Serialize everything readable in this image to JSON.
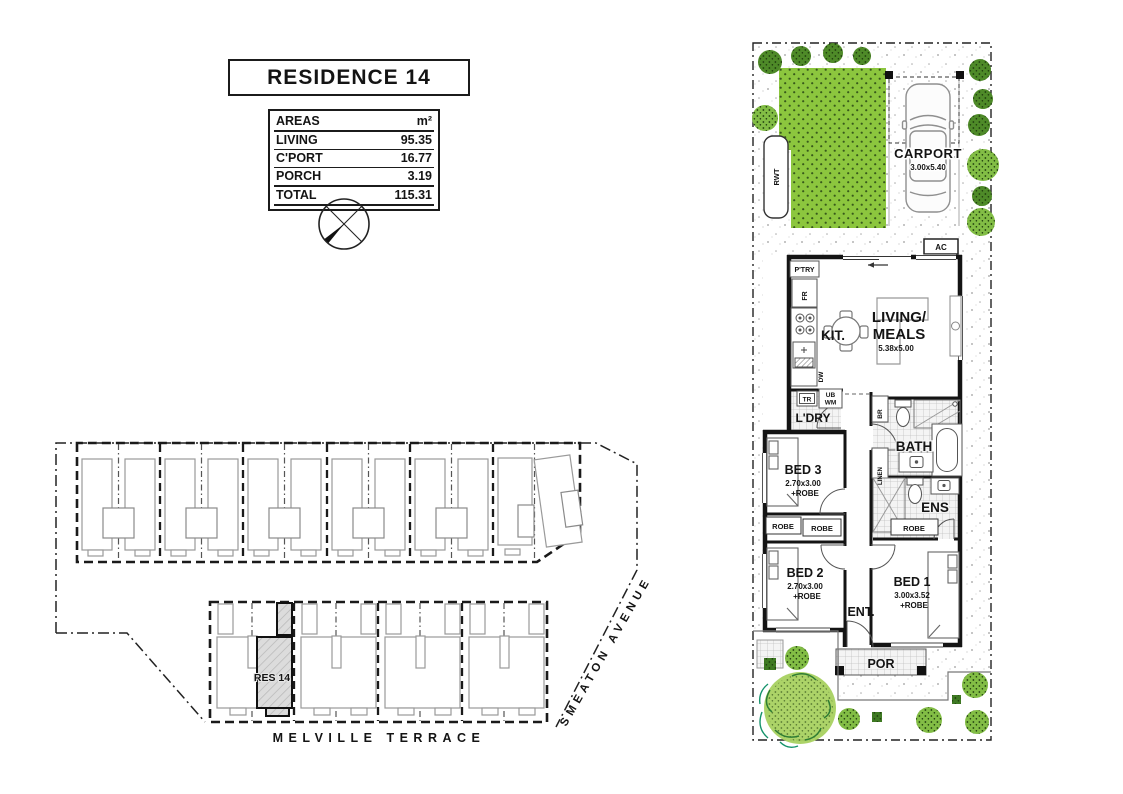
{
  "title": "RESIDENCE 14",
  "areas_table": {
    "header_label": "AREAS",
    "header_unit": "m²",
    "rows": [
      {
        "label": "LIVING",
        "value": "95.35"
      },
      {
        "label": "C'PORT",
        "value": "16.77"
      },
      {
        "label": "PORCH",
        "value": "3.19"
      }
    ],
    "total_label": "TOTAL",
    "total_value": "115.31"
  },
  "site_plan": {
    "highlighted_lot": "RES 14",
    "street_south": "MELVILLE TERRACE",
    "street_east": "SMEATON AVENUE"
  },
  "floor_plan": {
    "carport_label": "CARPORT",
    "carport_dims": "3.00x5.40",
    "living_label_1": "LIVING/",
    "living_label_2": "MEALS",
    "living_dims": "5.38x5.00",
    "kitchen_label": "KIT.",
    "pantry_label": "P'TRY",
    "fridge_label": "FR",
    "dishwasher_label": "DW",
    "laundry_label": "L'DRY",
    "trough_label": "TR",
    "tub_label_1": "UB",
    "tub_label_2": "WM",
    "bath_label": "BATH",
    "broom_label": "BR",
    "linen_label": "LINEN",
    "ens_label": "ENS",
    "robe_label": "ROBE",
    "bed1_label": "BED 1",
    "bed1_dims": "3.00x3.52",
    "bed1_robe": "+ROBE",
    "bed2_label": "BED 2",
    "bed2_dims": "2.70x3.00",
    "bed2_robe": "+ROBE",
    "bed3_label": "BED 3",
    "bed3_dims": "2.70x3.00",
    "bed3_robe": "+ROBE",
    "entry_label": "ENT.",
    "porch_label": "POR",
    "rwt_label": "RWT",
    "ac_label": "AC"
  },
  "colors": {
    "lawn": "#8cc63e",
    "tree_light": "#82bd45",
    "tree_dark": "#4e8a28",
    "canopy": "#a8d160",
    "highlight_fill": "#dcdcdc",
    "wall": "#141414"
  }
}
